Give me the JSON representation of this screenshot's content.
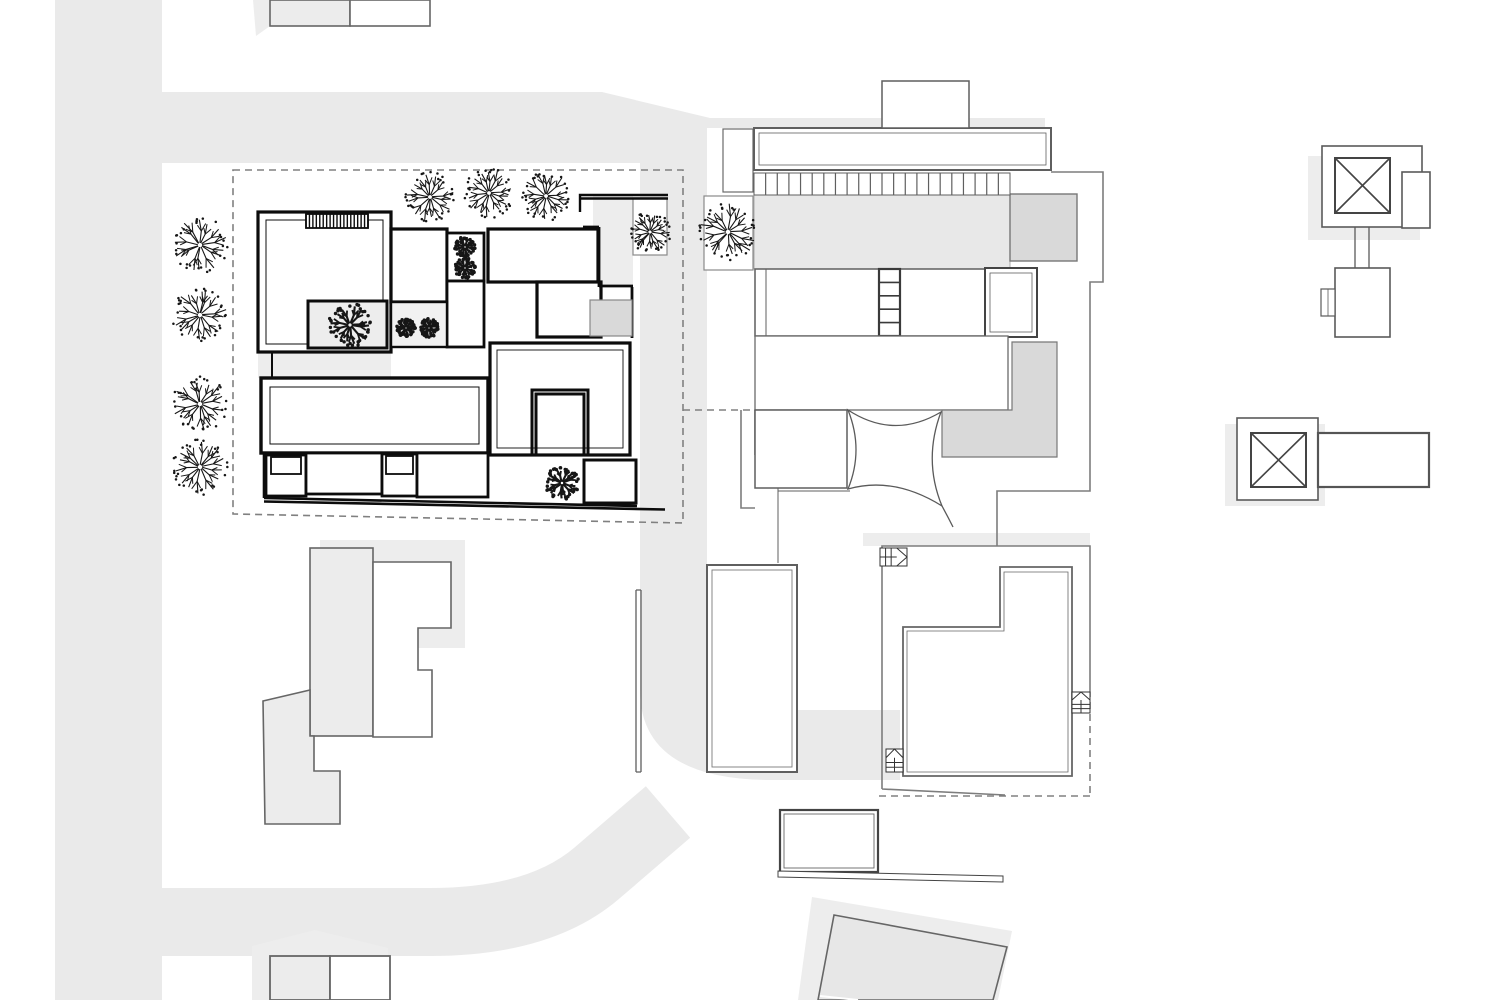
{
  "document": {
    "kind": "architectural-site-plan",
    "view": "roof plan with site context, no text labels visible"
  },
  "colors": {
    "background": "#ffffff",
    "road": "#eaeaea",
    "shadow": "#ededed",
    "terrace": "#e8e8e8",
    "panel_dark": "#d9d9d9",
    "line_thin": "#5f5f5f",
    "line_plot": "#7d7d7d",
    "line_thick": "#0c0c0c",
    "line_dash": "#808080",
    "tree": "#161616"
  },
  "scene": {
    "parcel_boundary_main": {
      "x1": 233,
      "y1": 170,
      "x2": 683,
      "y2": 523
    },
    "parcel_boundary_neighbor_segments": [
      {
        "d": "M683,410 H757"
      },
      {
        "d": "M1090,690 V796"
      },
      {
        "d": "M1090,796 H878"
      }
    ],
    "trees_outline": [
      {
        "x": 200,
        "y": 245,
        "r": 27
      },
      {
        "x": 200,
        "y": 315,
        "r": 27
      },
      {
        "x": 200,
        "y": 404,
        "r": 27
      },
      {
        "x": 200,
        "y": 467,
        "r": 27
      },
      {
        "x": 430,
        "y": 197,
        "r": 24
      },
      {
        "x": 489,
        "y": 193,
        "r": 24
      },
      {
        "x": 546,
        "y": 196,
        "r": 24
      },
      {
        "x": 650,
        "y": 232,
        "r": 20
      },
      {
        "x": 728,
        "y": 232,
        "r": 28
      }
    ],
    "trees_dark": [
      {
        "x": 350,
        "y": 325,
        "r": 21
      },
      {
        "x": 465,
        "y": 247,
        "r": 10
      },
      {
        "x": 465,
        "y": 268,
        "r": 10
      },
      {
        "x": 406,
        "y": 328,
        "r": 9
      },
      {
        "x": 429,
        "y": 328,
        "r": 9
      },
      {
        "x": 562,
        "y": 483,
        "r": 16
      }
    ],
    "tree_frames": [
      {
        "x": 633,
        "y": 198,
        "w": 34,
        "h": 57
      },
      {
        "x": 704,
        "y": 196,
        "w": 49,
        "h": 74
      }
    ],
    "pergola": {
      "x": 754,
      "y": 173,
      "w": 256,
      "h": 22,
      "slats": 22
    },
    "hatch_strip": {
      "x": 306,
      "y": 214,
      "w": 62,
      "h": 14,
      "lines": 18
    },
    "stair_ladder": {
      "x": 879,
      "y": 269,
      "w": 21,
      "h": 67,
      "rungs": 4
    },
    "stair_symbols": [
      {
        "x": 880,
        "y": 548,
        "w": 27,
        "h": 18,
        "dir": "right"
      },
      {
        "x": 1072,
        "y": 692,
        "w": 18,
        "h": 21,
        "dir": "up"
      },
      {
        "x": 886,
        "y": 749,
        "w": 17,
        "h": 23,
        "dir": "up"
      }
    ],
    "structures": [
      {
        "name": "main-building-complex",
        "bounds": [
          258,
          195,
          665,
          509
        ]
      },
      {
        "name": "neighbor-building",
        "bounds": [
          704,
          81,
          1103,
          565
        ]
      },
      {
        "name": "sail-shade-canopy",
        "bounds": [
          848,
          410,
          953,
          527
        ]
      },
      {
        "name": "pool-court",
        "bounds": [
          707,
          565,
          797,
          772
        ]
      },
      {
        "name": "garage-annex",
        "bounds": [
          780,
          810,
          878,
          872
        ]
      },
      {
        "name": "courtyard-house-southeast",
        "bounds": [
          882,
          533,
          1090,
          797
        ]
      },
      {
        "name": "rotated-building-south",
        "bounds": [
          818,
          915,
          1007,
          1000
        ]
      },
      {
        "name": "southwest-building",
        "bounds": [
          263,
          548,
          451,
          824
        ]
      },
      {
        "name": "corner-building-southwest",
        "bounds": [
          270,
          956,
          390,
          1000
        ]
      },
      {
        "name": "top-edge-building",
        "bounds": [
          270,
          0,
          430,
          26
        ]
      },
      {
        "name": "east-building-north",
        "bounds": [
          1321,
          146,
          1430,
          337
        ]
      },
      {
        "name": "east-building-south",
        "bounds": [
          1237,
          418,
          1429,
          500
        ]
      }
    ]
  }
}
